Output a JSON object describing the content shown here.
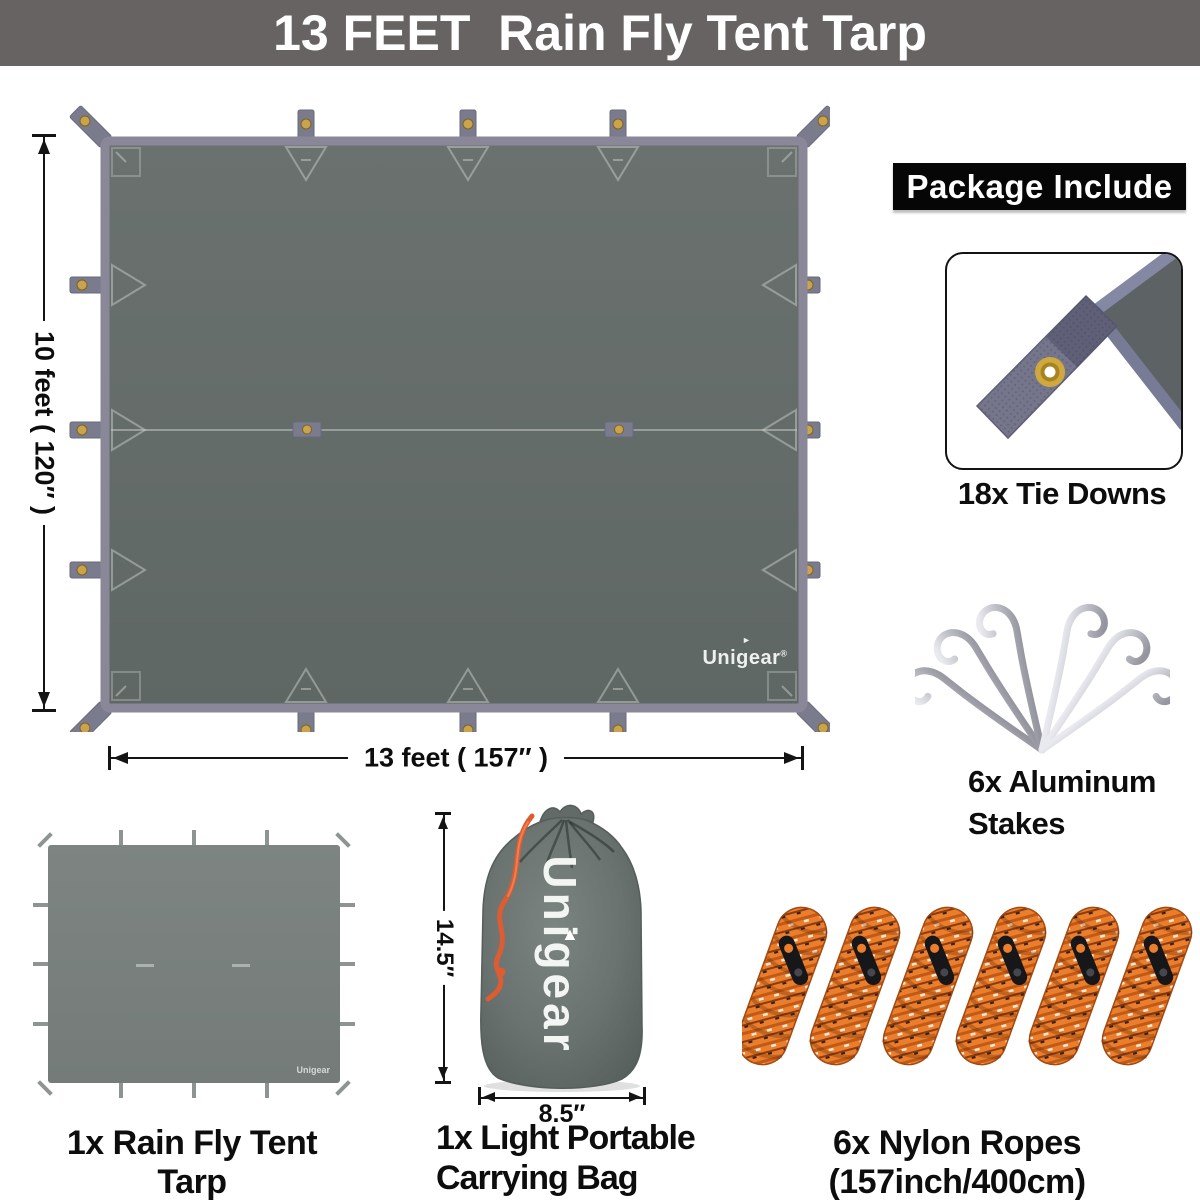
{
  "header": {
    "title": "13 FEET  Rain Fly Tent Tarp"
  },
  "brand": {
    "name": "Unigear",
    "registered": "®"
  },
  "tarp_diagram": {
    "height_label": "10 feet ( 120″ )",
    "width_label": "13 feet ( 157″ )"
  },
  "package_panel": {
    "title": "Package Include",
    "tie_downs_label": "18x Tie Downs",
    "stakes_label_line1": "6x Aluminum",
    "stakes_label_line2": "Stakes"
  },
  "bottom_row": {
    "tarp_label": "1x Rain Fly Tent Tarp",
    "bag_height_label": "14.5″",
    "bag_width_label": "8.5″",
    "bag_label_line1": "1x Light Portable",
    "bag_label_line2": "Carrying Bag",
    "ropes_label": "6x Nylon Ropes (157inch/400cm)"
  },
  "icons": {
    "brand_triangle": "►",
    "bag_triangle": "▲"
  },
  "colors": {
    "banner_bg": "#676363",
    "tarp_fill": "#666d6b",
    "tarp_border": "#8a8798",
    "grommet_gold": "#c9a24a",
    "rope_orange": "#e8792c",
    "drawstring_orange": "#dd5c31",
    "panel_black": "#060606"
  }
}
